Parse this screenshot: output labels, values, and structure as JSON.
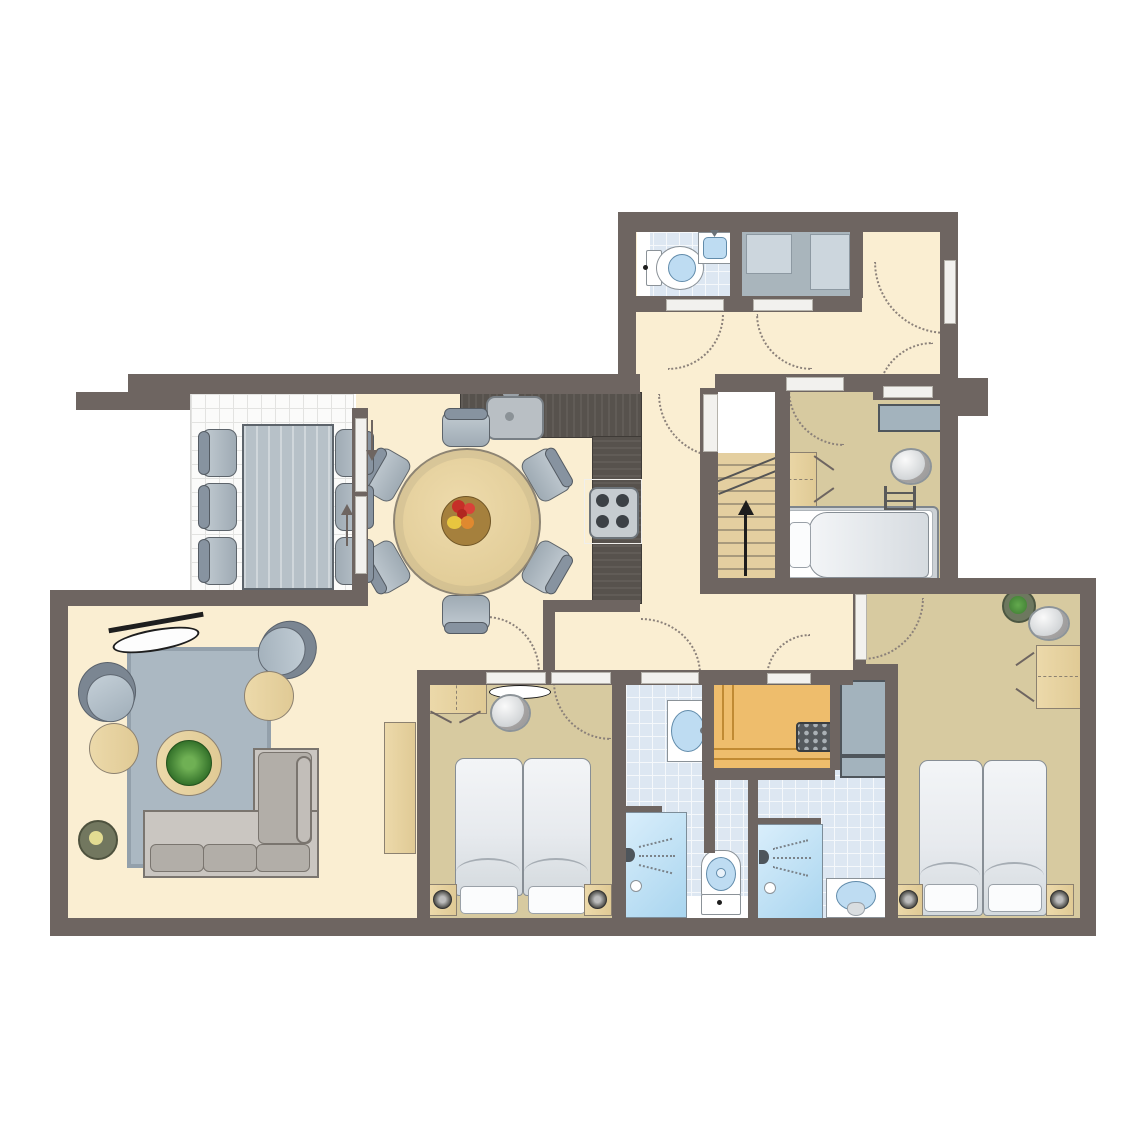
{
  "document": {
    "type": "floor-plan",
    "title": "Holiday apartment floor plan",
    "visible_text": []
  },
  "palette": {
    "wall": "#6e6561",
    "floor_cream": "#faeed2",
    "floor_tan": "#d7caa0",
    "tile_blue": "#dde7f2",
    "terrace_white": "#fbfbfa",
    "sauna_wood": "#eebd6c",
    "counter_dark": "#57524d",
    "furniture_wood": "#e8d5a5",
    "rug_blue": "#abb8c2",
    "chair_gray": "#a9b4bd",
    "shower_glass": "#c7e3f5",
    "fixture_white": "#ffffff",
    "accent_black": "#1d1d1d"
  },
  "rooms": [
    {
      "name": "terrace",
      "furniture": [
        "outdoor-table",
        "6 outdoor-chairs",
        "sliding-doors"
      ]
    },
    {
      "name": "dining-area",
      "furniture": [
        "round-table",
        "6 chairs",
        "fruit-bowl"
      ]
    },
    {
      "name": "kitchen",
      "furniture": [
        "l-counter",
        "sink",
        "cooktop"
      ]
    },
    {
      "name": "wc",
      "furniture": [
        "toilet",
        "corner-sink"
      ]
    },
    {
      "name": "storage-room",
      "furniture": [
        "cabinet",
        "cabinet"
      ]
    },
    {
      "name": "entry-hall",
      "furniture": [
        "front-door",
        "shelf"
      ]
    },
    {
      "name": "stairwell",
      "furniture": [
        "stairs-up",
        "landing"
      ]
    },
    {
      "name": "bedroom-2",
      "furniture": [
        "double-bed",
        "ladder",
        "wardrobe",
        "mirror",
        "shelf"
      ]
    },
    {
      "name": "living-room",
      "furniture": [
        "l-sofa",
        "rug",
        "coffee-table-plant",
        "2 side-tables",
        "2 tub-chairs",
        "ceiling-lamp",
        "floor-lamp",
        "sideboard"
      ]
    },
    {
      "name": "bedroom-1",
      "furniture": [
        "2 single-beds",
        "2 nightstands",
        "wardrobe",
        "mirror",
        "wall-lamp"
      ]
    },
    {
      "name": "bathroom-1",
      "furniture": [
        "shower",
        "toilet",
        "sink"
      ]
    },
    {
      "name": "sauna",
      "furniture": [
        "benches",
        "heater"
      ]
    },
    {
      "name": "bathroom-2",
      "furniture": [
        "shower",
        "pedestal-sink"
      ]
    },
    {
      "name": "bedroom-3",
      "furniture": [
        "2 single-beds",
        "2 nightstands",
        "wardrobe",
        "mirror",
        "plant"
      ]
    }
  ]
}
